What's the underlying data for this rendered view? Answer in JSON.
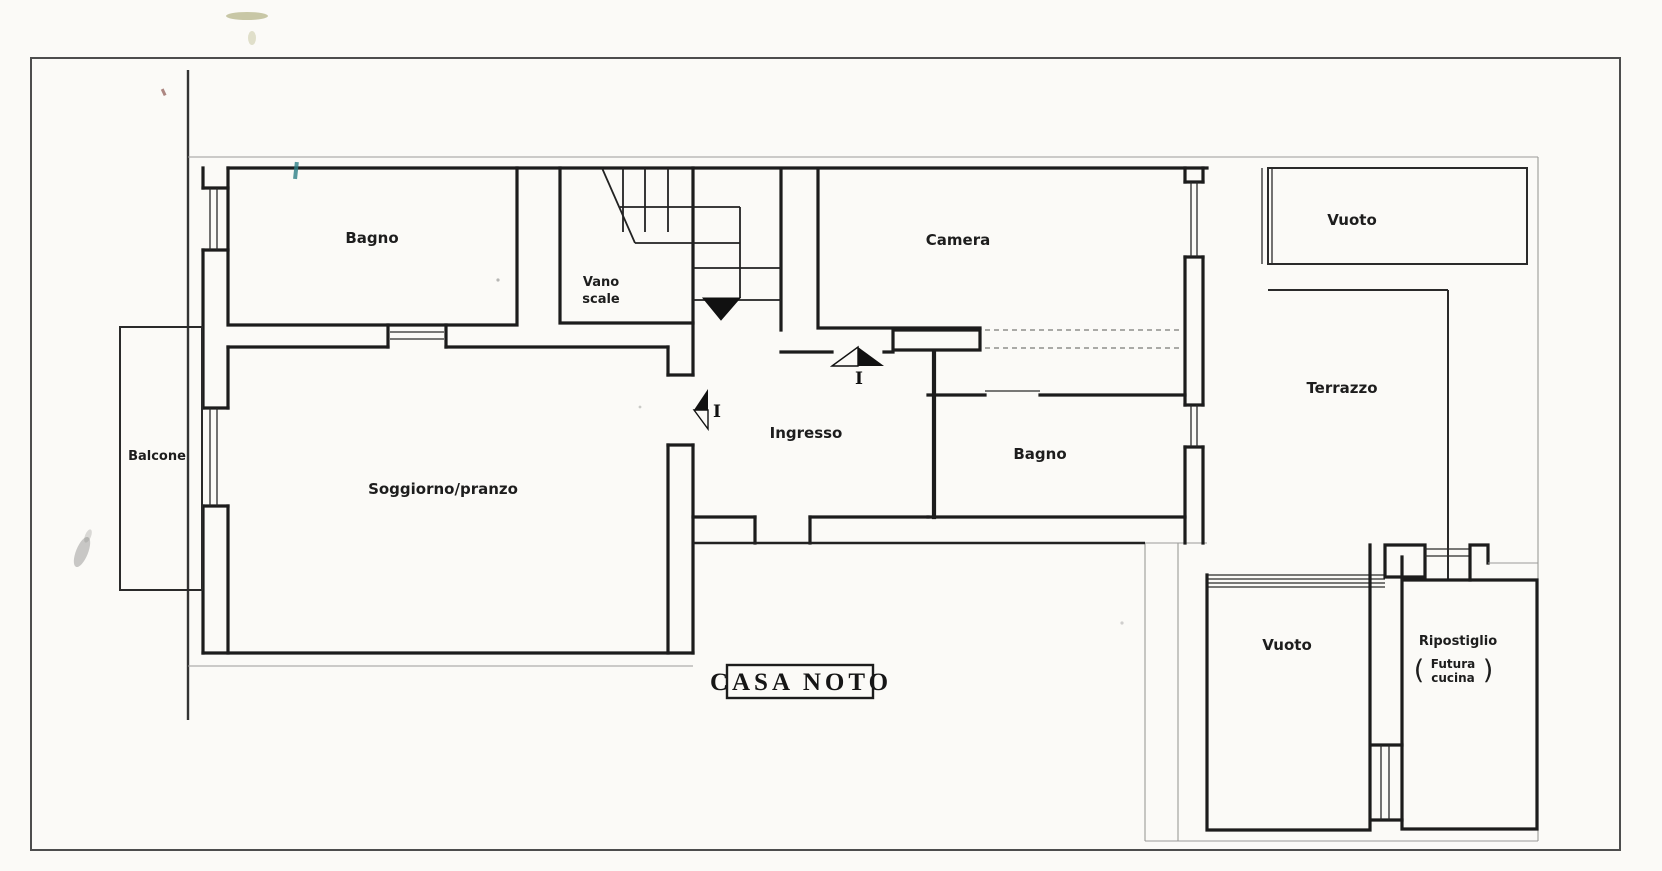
{
  "document": {
    "type": "scanned-floor-plan",
    "title": "CASA NOTO"
  },
  "labels": {
    "bagno_top_left": "Bagno",
    "vano_scale_line1": "Vano",
    "vano_scale_line2": "scale",
    "camera": "Camera",
    "ingresso": "Ingresso",
    "soggiorno": "Soggiorno/pranzo",
    "balcone": "Balcone",
    "bagno_right": "Bagno",
    "vuoto_top": "Vuoto",
    "terrazzo": "Terrazzo",
    "vuoto_bottom": "Vuoto",
    "ripostiglio": "Ripostiglio",
    "futura_cucina_line1": "Futura",
    "futura_cucina_line2": "cucina",
    "paren_open": "(",
    "paren_close": ")",
    "door_marker_1": "I",
    "door_marker_2": "I"
  },
  "colors": {
    "paper": "#fbfaf7",
    "ink": "#1c1c1c",
    "faint_line": "#9b9b98",
    "smudge_olive": "#8a8a42",
    "smudge_teal": "#2e7f86",
    "smudge_gray": "#8a8a88",
    "speck_red": "#7a3a34"
  }
}
